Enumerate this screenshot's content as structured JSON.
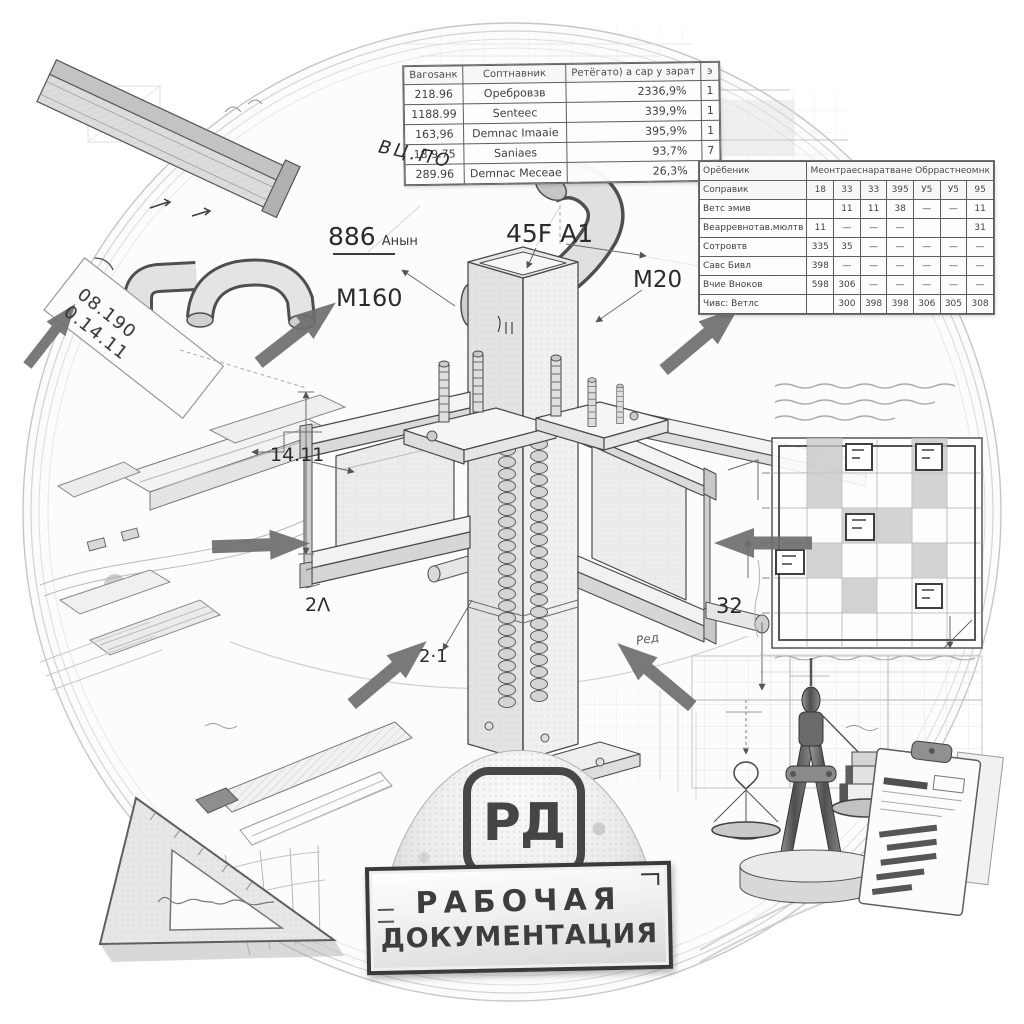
{
  "colors": {
    "ink": "#3c3c3c",
    "pencil": "#8f8f8f",
    "paper": "#fbfbfb",
    "arrow": "#6d6d6d",
    "badge_ink": "#454545"
  },
  "tables": {
    "spec": {
      "header_rows": 1,
      "rows": [
        [
          "Вагоsанк",
          "Соптнавник",
          "Ретёгато) а сар у зарат",
          "э"
        ],
        [
          "218.96",
          "Оребровзв",
          "2336,9%",
          "1"
        ],
        [
          "1188.99",
          "Senteec",
          "339,9%",
          "1"
        ],
        [
          "163,96",
          "Demnac Imaaie",
          "395,9%",
          "1"
        ],
        [
          "18.9.75",
          "Saniaes",
          "93,7%",
          "7"
        ],
        [
          "289.96",
          "Demnac Meceae",
          "26,3%",
          "1"
        ]
      ]
    },
    "matrix": {
      "header_rows": 2,
      "rows": [
        [
          {
            "t": "Орёбеник"
          },
          {
            "t": "Меонтраеснаратване Обррастнеомнк",
            "cs": 7
          }
        ],
        [
          "Соправик",
          "18",
          "33",
          "33",
          "395",
          "У5",
          "У5",
          "95"
        ],
        [
          "Ветс эмив",
          "",
          "11",
          "11",
          "38",
          "—",
          "—",
          "11"
        ],
        [
          "Веарревнотав.мюлтв",
          "11",
          "—",
          "—",
          "—",
          "",
          "",
          "31"
        ],
        [
          "Сотровтв",
          "335",
          "35",
          "—",
          "—",
          "—",
          "—",
          "—"
        ],
        [
          "Савс Бивл",
          "398",
          "—",
          "—",
          "—",
          "—",
          "—",
          "—"
        ],
        [
          "Вчие Вноков",
          "598",
          "306",
          "—",
          "—",
          "—",
          "—",
          "—"
        ],
        [
          "Чивс: Ветлс",
          "",
          "300",
          "398",
          "398",
          "306",
          "305",
          "308"
        ]
      ]
    }
  },
  "labels": {
    "mark_886": {
      "big": "886",
      "small": "Анын"
    },
    "mark_45f": "45F A1",
    "m160": "М160",
    "m20": "M20",
    "dim_1411": "14.11",
    "dim_2l": "2Λ",
    "dim_21": "2·1",
    "dim_32": "32",
    "sheet": {
      "line1": "08.190",
      "line2": "0.14.11"
    },
    "pipe_note": "ВЦ.ПО",
    "red_note": "Ред"
  },
  "badge": {
    "logo": "РД",
    "plate_line1": "РАБОЧАЯ",
    "plate_line2": "ДОКУМЕНТАЦИЯ"
  }
}
